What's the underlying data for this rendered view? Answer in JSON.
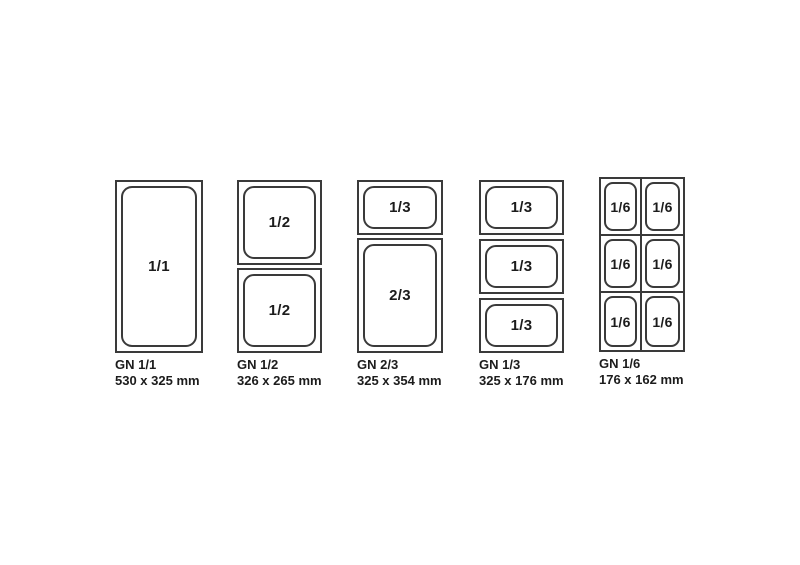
{
  "colors": {
    "background": "#ffffff",
    "line": "#3a3a3a",
    "text": "#1c1c1c"
  },
  "figures": [
    {
      "caption_name": "GN 1/1",
      "caption_size": "530 x 325 mm",
      "sections": [
        {
          "label": "1/1"
        }
      ]
    },
    {
      "caption_name": "GN 1/2",
      "caption_size": "326 x 265 mm",
      "sections": [
        {
          "label": "1/2"
        },
        {
          "label": "1/2"
        }
      ]
    },
    {
      "caption_name": "GN 2/3",
      "caption_size": "325 x 354 mm",
      "sections": [
        {
          "label": "1/3"
        },
        {
          "label": "2/3"
        }
      ]
    },
    {
      "caption_name": "GN 1/3",
      "caption_size": "325 x 176 mm",
      "sections": [
        {
          "label": "1/3"
        },
        {
          "label": "1/3"
        },
        {
          "label": "1/3"
        }
      ]
    },
    {
      "caption_name": "GN 1/6",
      "caption_size": "176 x 162 mm",
      "cells": [
        {
          "label": "1/6"
        },
        {
          "label": "1/6"
        },
        {
          "label": "1/6"
        },
        {
          "label": "1/6"
        },
        {
          "label": "1/6"
        },
        {
          "label": "1/6"
        }
      ]
    }
  ]
}
